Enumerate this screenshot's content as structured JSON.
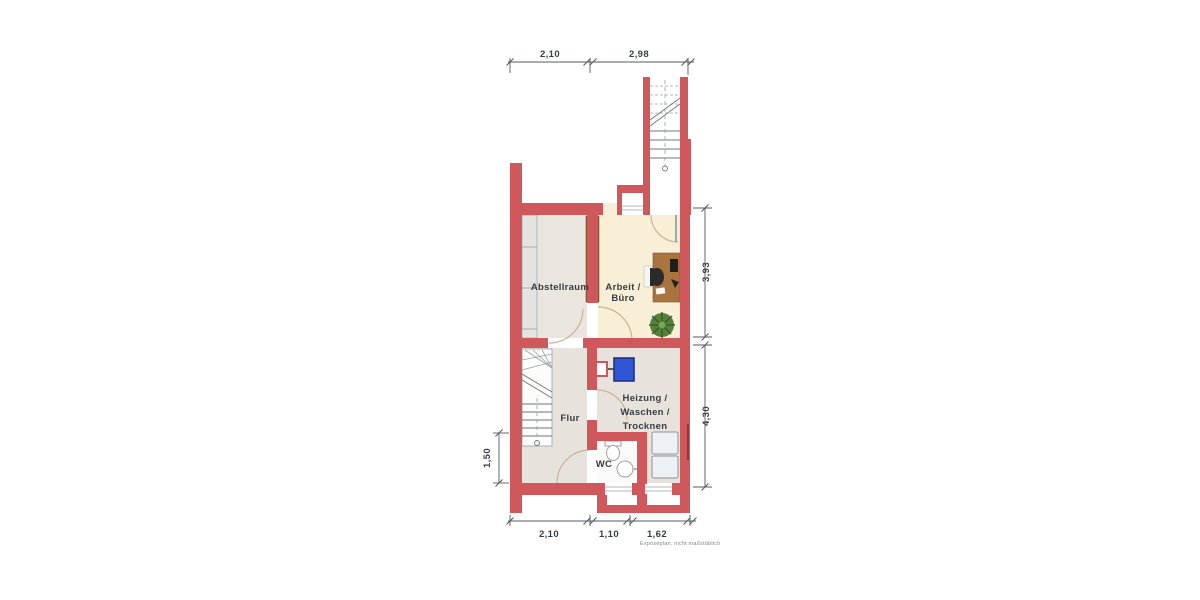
{
  "rooms": {
    "abstellraum": {
      "label": "Abstellraum"
    },
    "buero": {
      "line1": "Arbeit /",
      "line2": "Büro"
    },
    "flur": {
      "label": "Flur"
    },
    "heizung": {
      "line1": "Heizung /",
      "line2": "Waschen /",
      "line3": "Trocknen"
    },
    "wc": {
      "label": "WC"
    }
  },
  "dimensions": {
    "top": {
      "d1": "2,10",
      "d2": "2,98"
    },
    "bottom": {
      "d1": "2,10",
      "d2": "1,10",
      "d3": "1,62"
    },
    "right": {
      "d1": "3,93",
      "d2": "4,30"
    },
    "left": {
      "d1": "1,50"
    }
  },
  "footnote": "Exposéplan, nicht maßstäblich",
  "colors": {
    "wall": "#cf585c",
    "wall_watermark": "#8f2f34",
    "floor_abstellraum": "#eae5de",
    "floor_closet": "#e4e3df",
    "floor_buero": "#f8efd6",
    "floor_flur": "#e7e2db",
    "floor_wc": "#fbfaf8",
    "wood_shelf": "#8a5a35",
    "wood_desk": "#a9743f",
    "boiler_blue": "#3056d6",
    "plant_green": "#55803c",
    "appliance": "#edf1f5"
  }
}
